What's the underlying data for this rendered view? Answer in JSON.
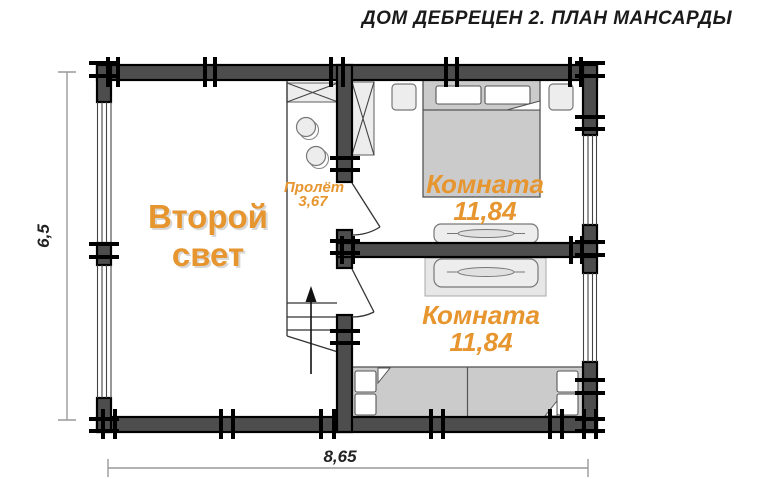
{
  "title": "ДОМ ДЕБРЕЦЕН 2. ПЛАН МАНСАРДЫ",
  "dimensions": {
    "height": "6,5",
    "width": "8,65"
  },
  "rooms": {
    "second_light": {
      "name": "Второй свет"
    },
    "stairwell": {
      "label": "Пролёт",
      "span": "3,67"
    },
    "bedroom_top": {
      "name": "Комната",
      "area": "11,84"
    },
    "bedroom_bottom": {
      "name": "Комната",
      "area": "11,84"
    }
  },
  "colors": {
    "accent_orange": "#e6952f",
    "wall_gray": "#4d4d4d",
    "furniture_gray": "#ededed",
    "bed_gray": "#cbcbcb",
    "dim_line_gray": "#999999",
    "title_black": "#1a1a1a"
  }
}
